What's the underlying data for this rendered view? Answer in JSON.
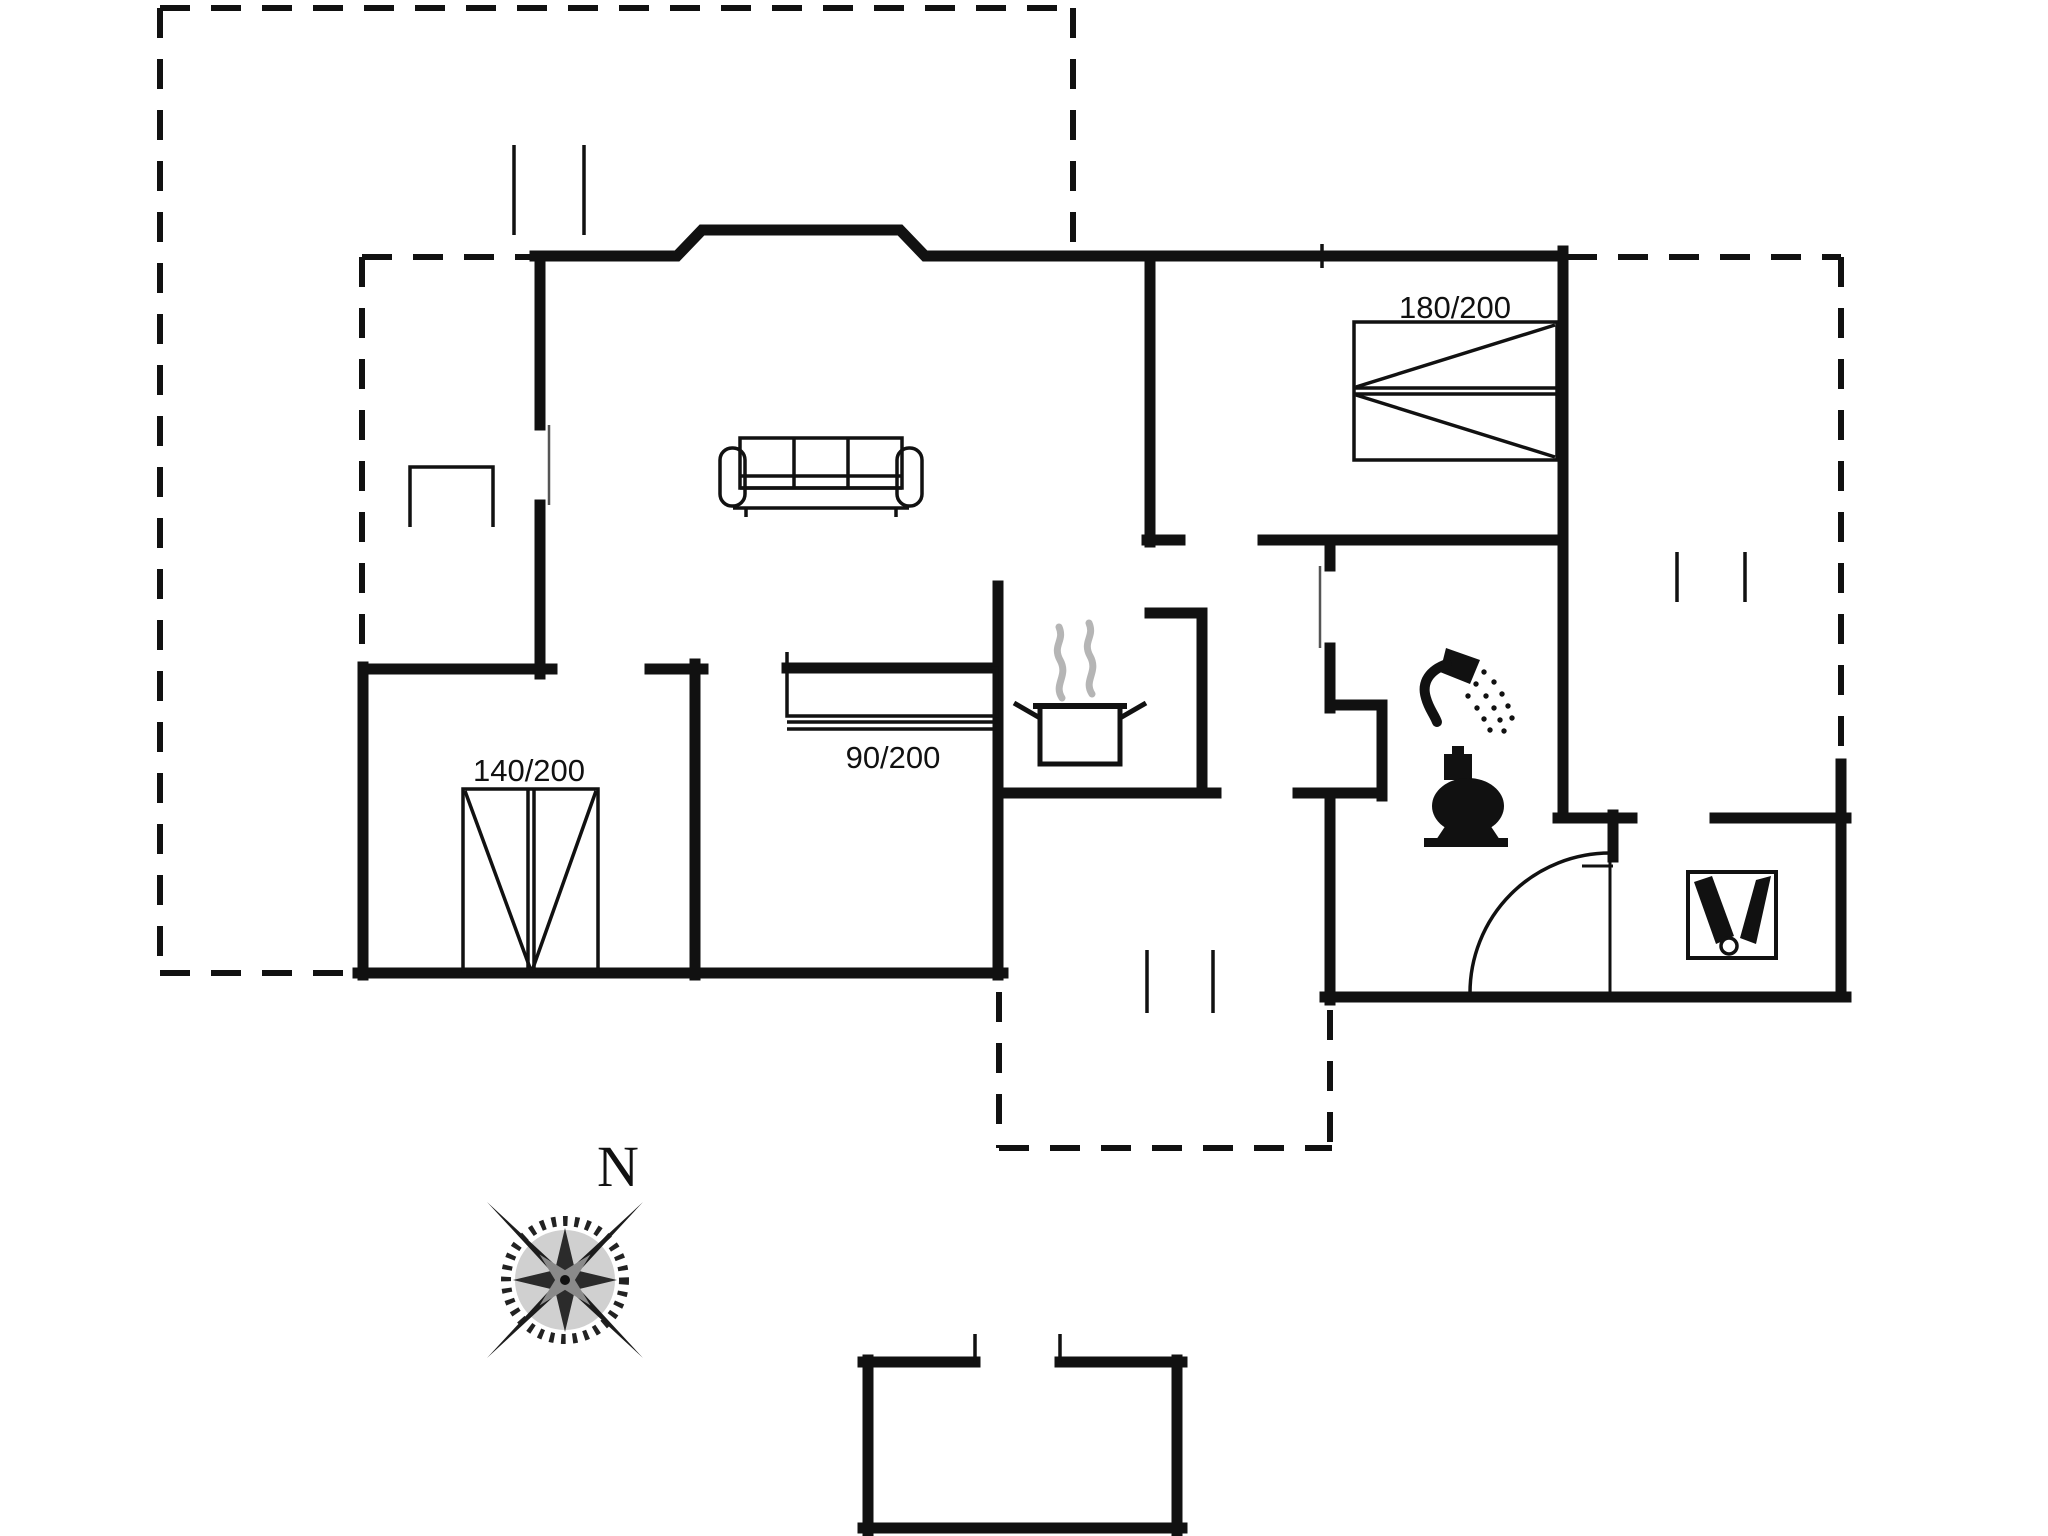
{
  "plan": {
    "type": "holiday-house-floor-plan",
    "labels": {
      "bed_master": "180/200",
      "bed_double": "140/200",
      "bed_single": "90/200",
      "compass_north": "N"
    },
    "colors": {
      "walls": "#111111",
      "background": "#ffffff",
      "steam": "#b5b5b5"
    },
    "icons": [
      "sofa-icon",
      "stove-pot-icon",
      "steam-icon",
      "shower-icon",
      "toilet-icon",
      "sink-icon",
      "door-swing-icon",
      "compass-rose-icon"
    ]
  }
}
